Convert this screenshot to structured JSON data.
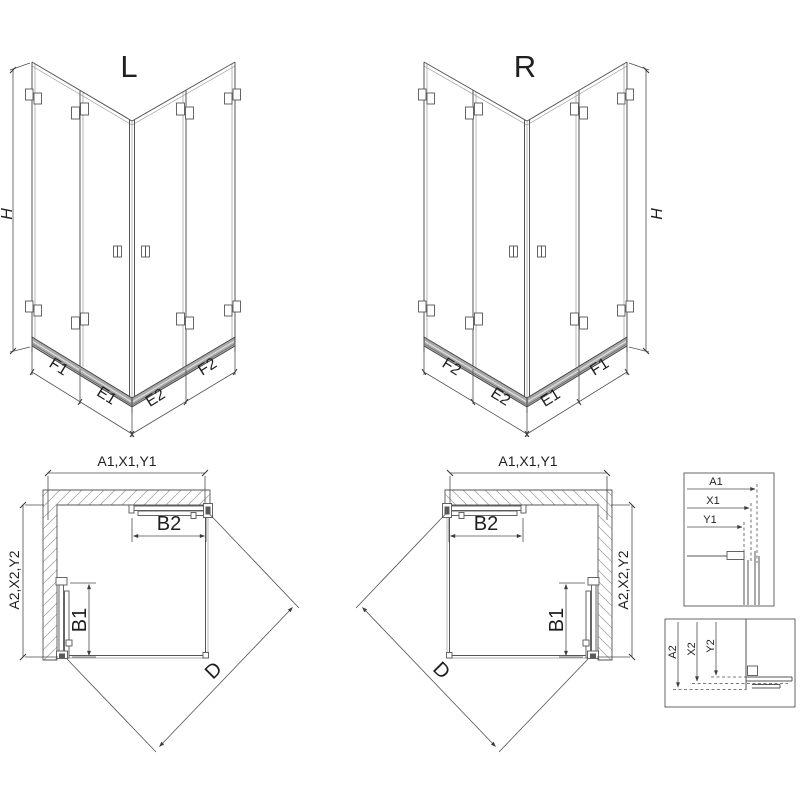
{
  "drawing": {
    "iso": {
      "left": {
        "title": "L",
        "segments": [
          "F1",
          "E1",
          "E2",
          "F2"
        ]
      },
      "right": {
        "title": "R",
        "segments": [
          "F2",
          "E2",
          "E1",
          "F1"
        ]
      },
      "height_label": "H"
    },
    "plan": {
      "width_label": "A1,X1,Y1",
      "depth_label": "A2,X2,Y2",
      "top_door_label": "B2",
      "side_door_label": "B1",
      "diagonal_label": "D"
    },
    "details": {
      "horizontal": {
        "labels": [
          "A1",
          "X1",
          "Y1"
        ]
      },
      "vertical": {
        "labels": [
          "A2",
          "X2",
          "Y2"
        ]
      }
    },
    "colors": {
      "line": "#555555",
      "text": "#1f1f1f",
      "rail": "#a9a9a9",
      "background": "#ffffff"
    }
  }
}
